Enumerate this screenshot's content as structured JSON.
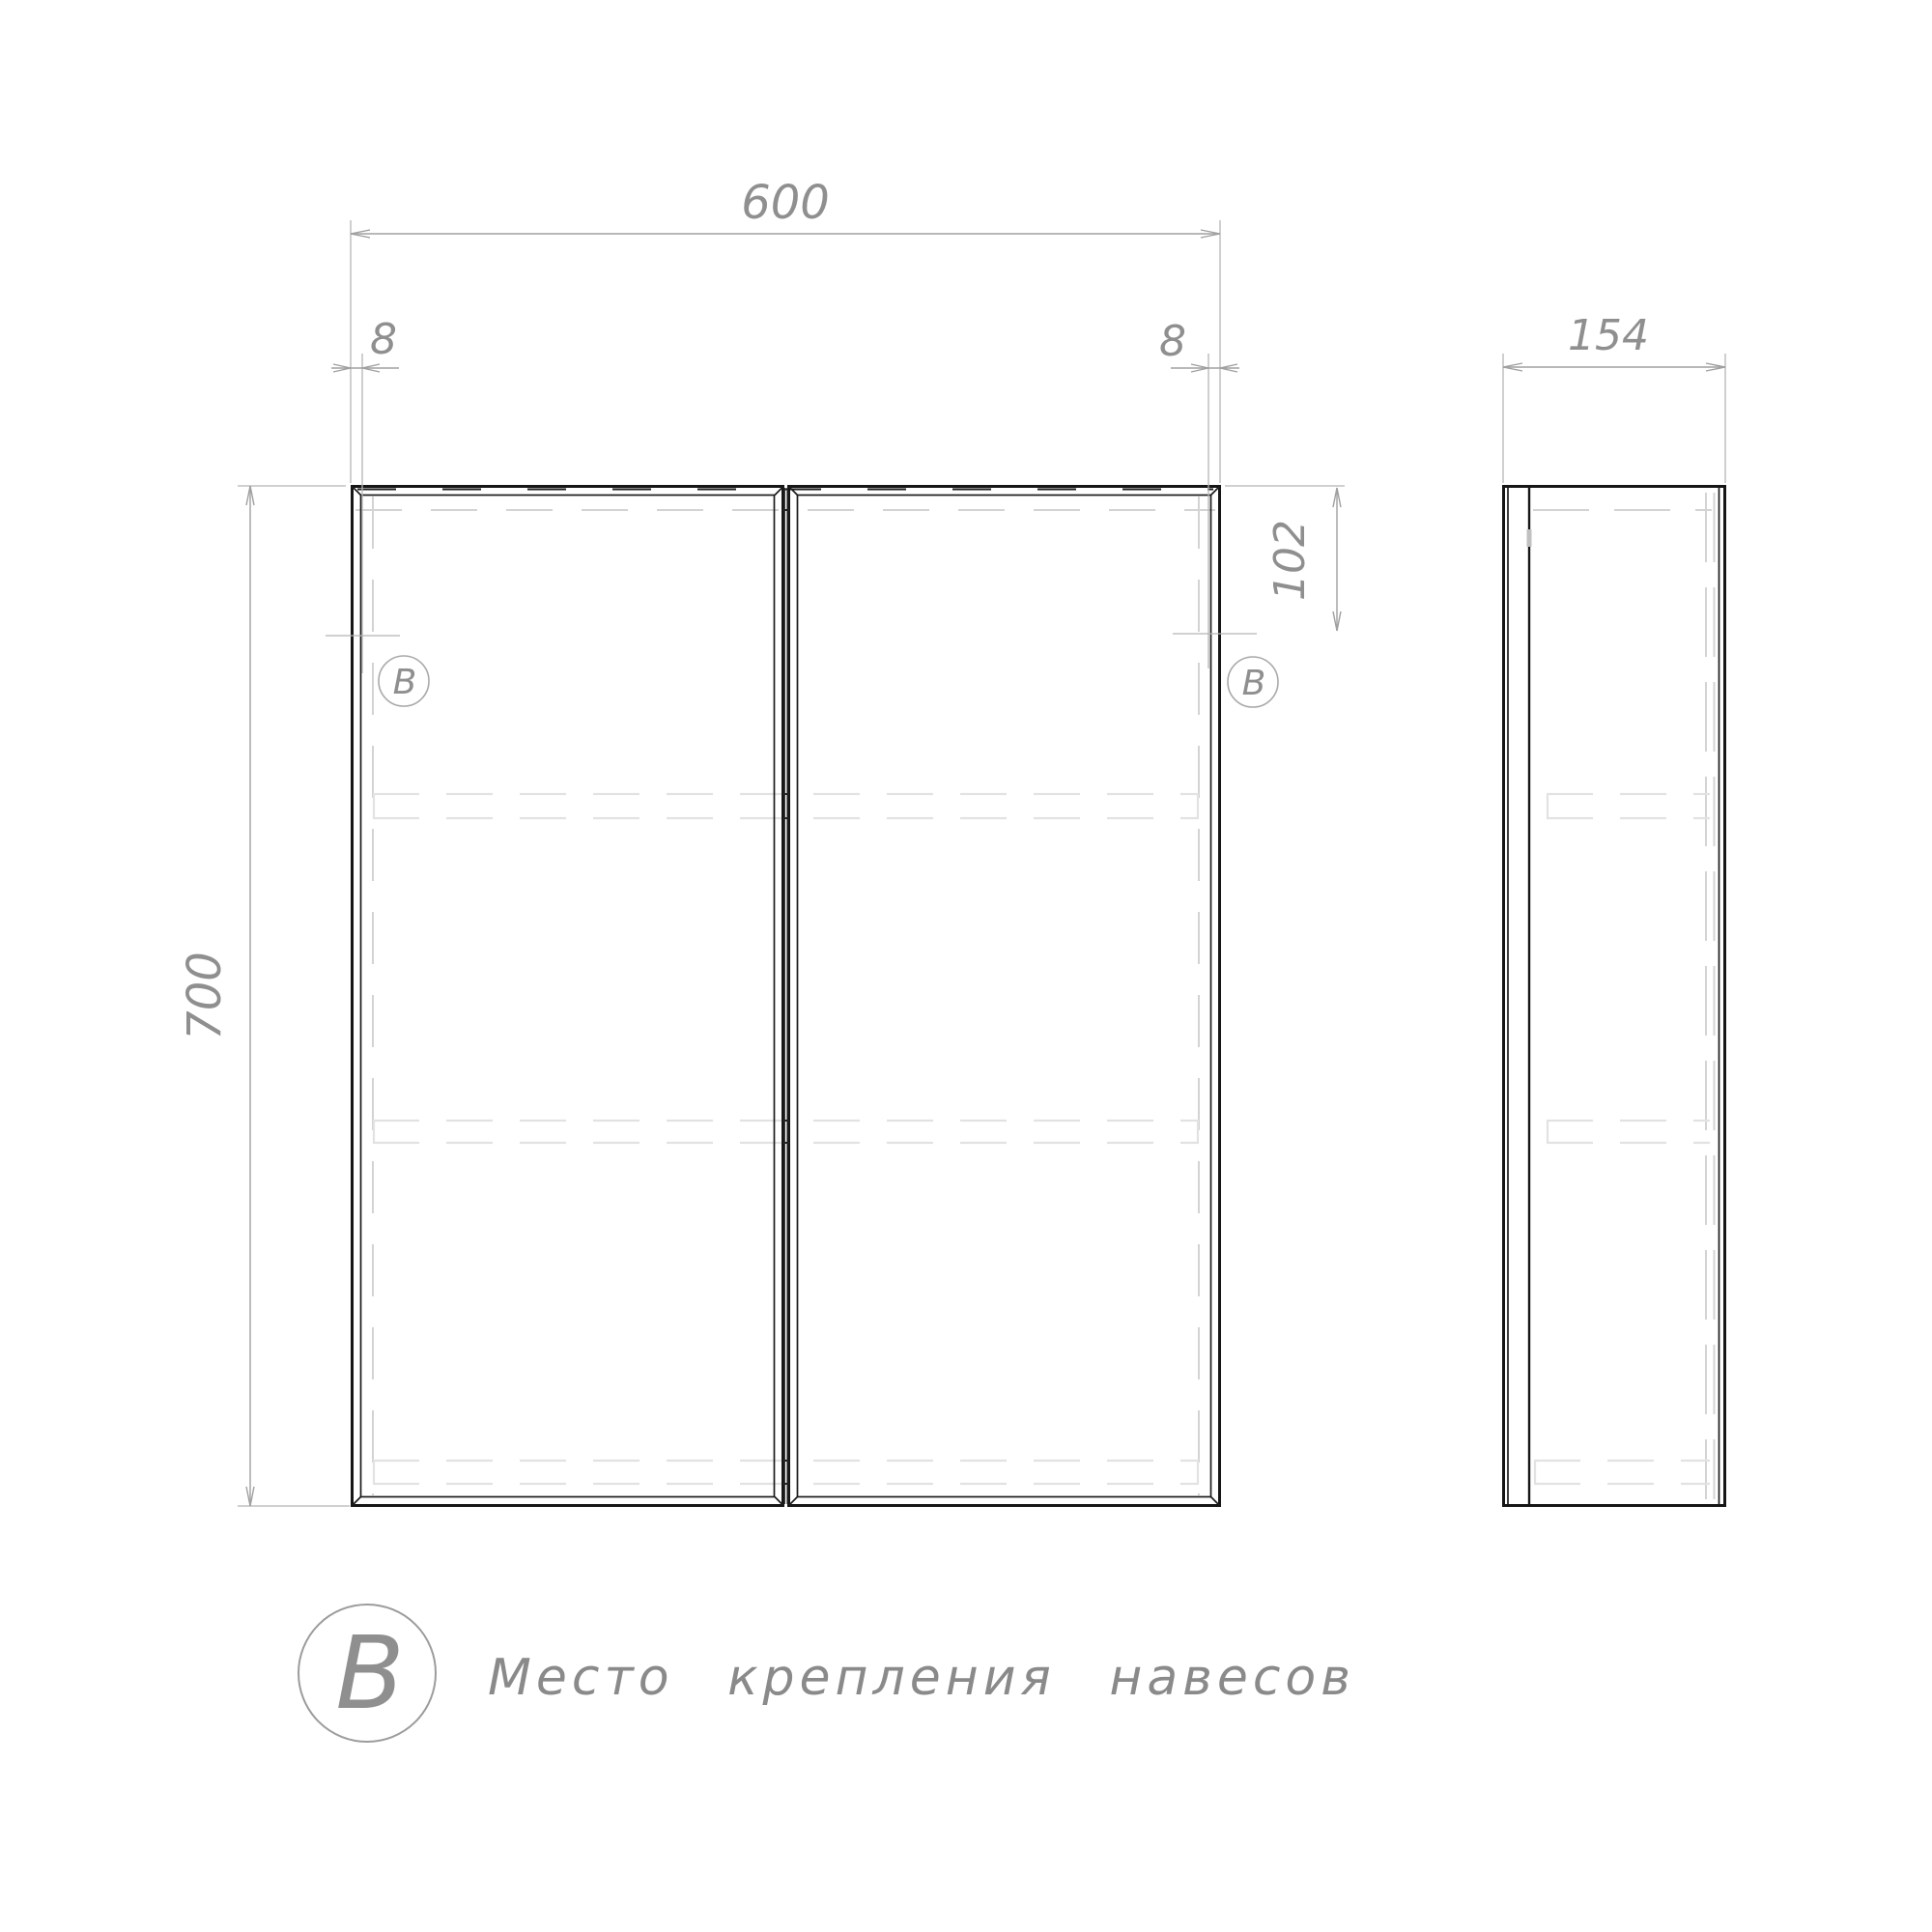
{
  "drawing_title": "Cabinet technical drawing (front and side views)",
  "colors": {
    "outline": "#161616",
    "dimension_lines": "#a0a0a0",
    "dimension_text": "#8f8f8f",
    "hidden_lines": "#d3d3d3",
    "shelf_lines": "#e2e2e2",
    "background": "#ffffff"
  },
  "front_view": {
    "width_mm": "600",
    "height_mm": "700",
    "hinge_inset_left_mm": "8",
    "hinge_inset_right_mm": "8",
    "hinge_top_offset_mm": "102",
    "hinge_marker": "B",
    "doors": 2,
    "shelves": 3
  },
  "side_view": {
    "depth_mm": "154"
  },
  "legend": {
    "symbol": "B",
    "text": "Место крепления навесов"
  }
}
